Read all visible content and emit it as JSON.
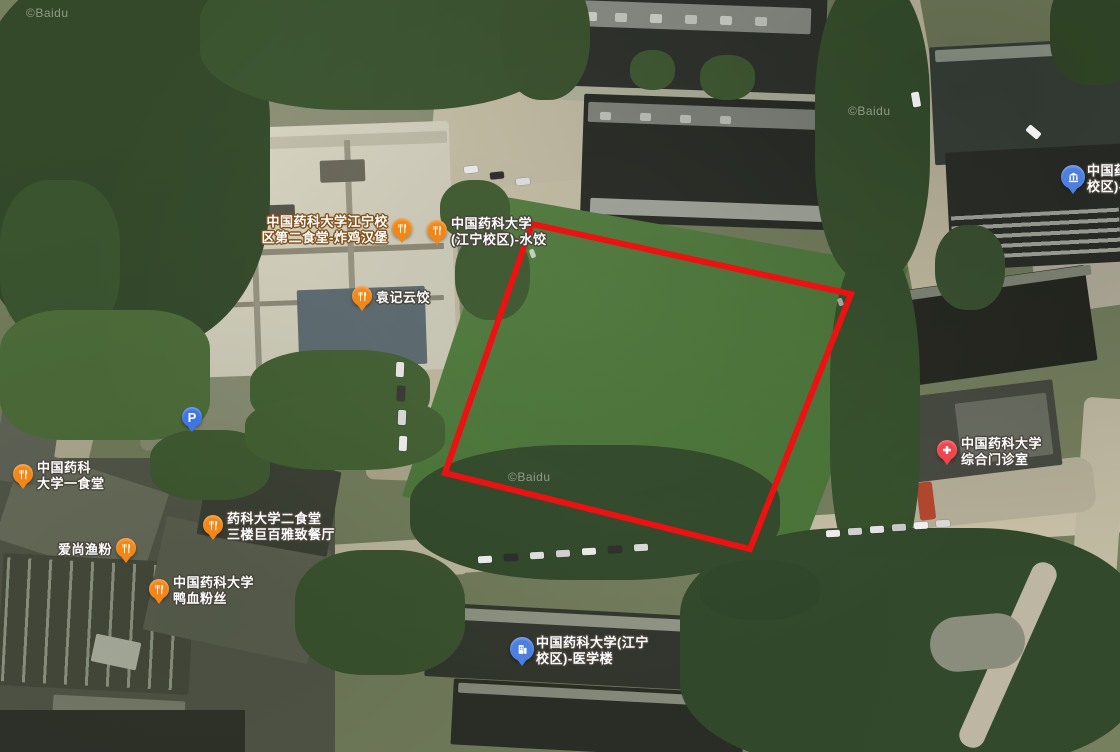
{
  "map": {
    "provider_watermark": "©Baidu",
    "view": "satellite"
  },
  "annotations": {
    "selection_polygon": {
      "stroke_color": "#ed1111",
      "stroke_width": 6,
      "fill": "none",
      "points": [
        [
          532,
          224
        ],
        [
          851,
          294
        ],
        [
          750,
          549
        ],
        [
          445,
          473
        ]
      ]
    }
  },
  "poi_style": {
    "restaurant_color": "#f28718",
    "parking_color": "#3d76e8",
    "clinic_color": "#f2444f",
    "building_color": "#4d7fe0",
    "label_text_color": "#ffffff",
    "default_outline": "#4a443c"
  },
  "pois": [
    {
      "id": "canteen2-fried-chicken",
      "type": "restaurant",
      "x": 402,
      "y": 231,
      "label_side": "left",
      "outline": "#84501a",
      "lines": [
        "中国药科大学江宁校",
        "区第二食堂-炸鸡汉堡"
      ]
    },
    {
      "id": "jiangning-shuijiao",
      "type": "restaurant",
      "x": 437,
      "y": 233,
      "label_side": "right",
      "outline": "#4a443c",
      "lines": [
        "中国药科大学",
        "(江宁校区)-水饺"
      ]
    },
    {
      "id": "yuanji-yunjiao",
      "type": "restaurant",
      "x": 362,
      "y": 299,
      "label_side": "right",
      "outline": "#4a443c",
      "lines": [
        "袁记云饺"
      ]
    },
    {
      "id": "parking-lot",
      "type": "parking",
      "x": 192,
      "y": 420,
      "label_side": "none",
      "outline": "#4a443c",
      "lines": []
    },
    {
      "id": "canteen1",
      "type": "restaurant",
      "x": 23,
      "y": 477,
      "label_side": "right",
      "outline": "#4a443c",
      "lines": [
        "中国药科",
        "大学一食堂"
      ]
    },
    {
      "id": "aishang-yufen",
      "type": "restaurant",
      "x": 126,
      "y": 551,
      "label_side": "left",
      "outline": "#4a443c",
      "lines": [
        "爱尚渔粉"
      ]
    },
    {
      "id": "canteen2-floor3-restaurant",
      "type": "restaurant",
      "x": 213,
      "y": 528,
      "label_side": "right",
      "outline": "#4a443c",
      "lines": [
        "药科大学二食堂",
        "三楼巨百雅致餐厅"
      ]
    },
    {
      "id": "duck-blood-vermicelli",
      "type": "restaurant",
      "x": 159,
      "y": 592,
      "label_side": "right",
      "outline": "#4a443c",
      "lines": [
        "中国药科大学",
        "鸭血粉丝"
      ]
    },
    {
      "id": "general-clinic",
      "type": "clinic",
      "x": 947,
      "y": 453,
      "label_side": "right",
      "outline": "#4a443c",
      "lines": [
        "中国药科大学",
        "综合门诊室"
      ]
    },
    {
      "id": "medical-building",
      "type": "building",
      "x": 522,
      "y": 652,
      "label_side": "right",
      "outline": "#4a443c",
      "lines": [
        "中国药科大学(江宁",
        "校区)-医学楼"
      ]
    },
    {
      "id": "campus-northeast",
      "type": "campus",
      "x": 1073,
      "y": 180,
      "label_side": "right",
      "outline": "#4a443c",
      "lines": [
        "中国药科",
        "校区)-"
      ]
    }
  ]
}
